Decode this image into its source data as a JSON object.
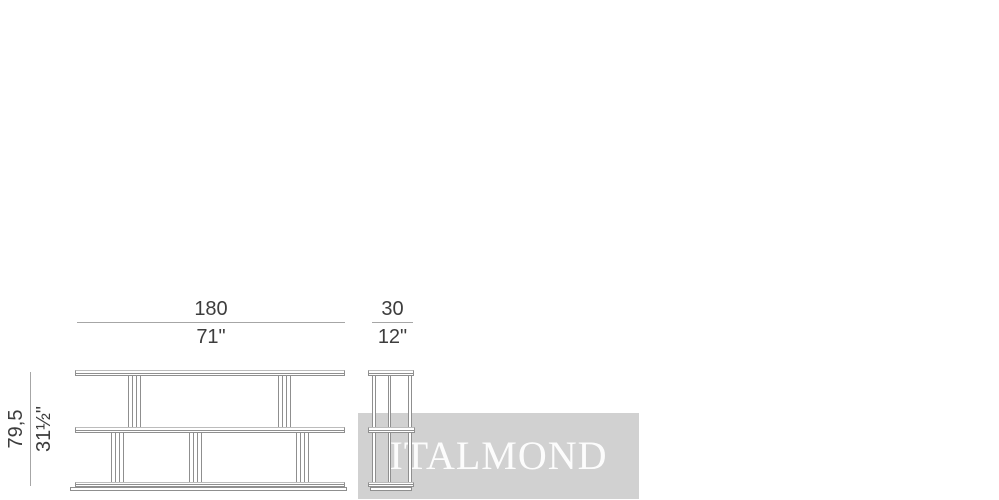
{
  "drawing": {
    "subject": "three-shelf console technical drawing",
    "views": {
      "front": "front elevation",
      "side": "side elevation"
    }
  },
  "dimensions": {
    "width": {
      "metric": "180",
      "imperial": "71\""
    },
    "depth": {
      "metric": "30",
      "imperial": "12\""
    },
    "height": {
      "metric": "79,5",
      "imperial": "31½\""
    }
  },
  "watermark": {
    "text": "ITALMOND"
  },
  "colors": {
    "line": "#8f8f8f",
    "dimension_line": "#a6a6a6",
    "label_text": "#3d3d3d",
    "watermark_band": "#d1d1d1",
    "watermark_text": "#ffffff"
  }
}
